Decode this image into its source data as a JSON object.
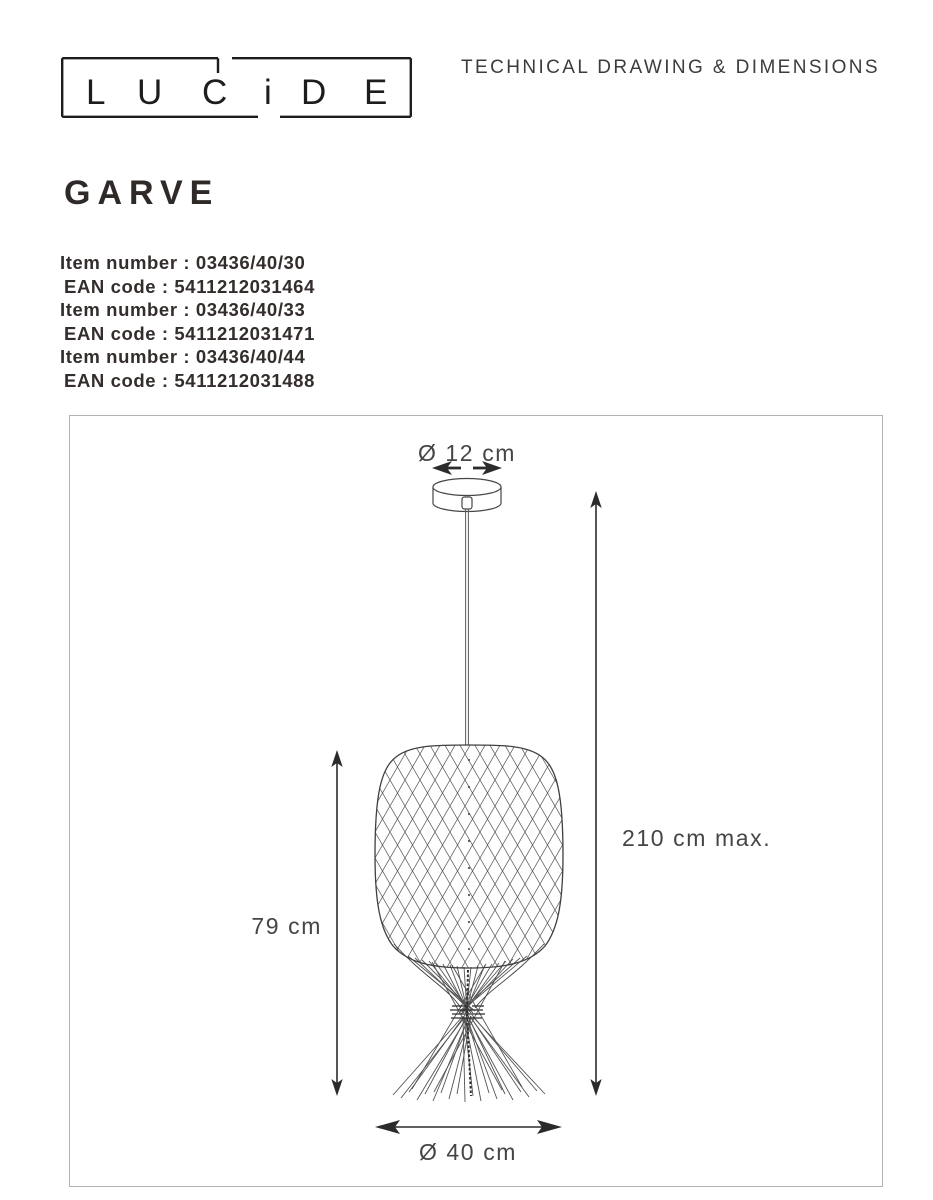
{
  "brand": {
    "name": "LUCIDE",
    "letters": [
      "L",
      "U",
      "C",
      "i",
      "D",
      "E"
    ]
  },
  "header": {
    "title": "TECHNICAL DRAWING & DIMENSIONS"
  },
  "product": {
    "name": "GARVE",
    "codes": [
      "Item number : 03436/40/30",
      "EAN code : 5411212031464",
      "Item number : 03436/40/33",
      "EAN code : 5411212031471",
      "Item number : 03436/40/44",
      "EAN code : 5411212031488"
    ]
  },
  "drawing": {
    "labels": {
      "canopy_diameter": "Ø 12 cm",
      "shade_height": "79 cm",
      "max_height": "210 cm max.",
      "bottom_diameter": "Ø 40 cm"
    }
  },
  "colors": {
    "ink": "#2f2a28",
    "drawing_line": "#3d3d3d",
    "frame_border": "#b3b3b3"
  }
}
